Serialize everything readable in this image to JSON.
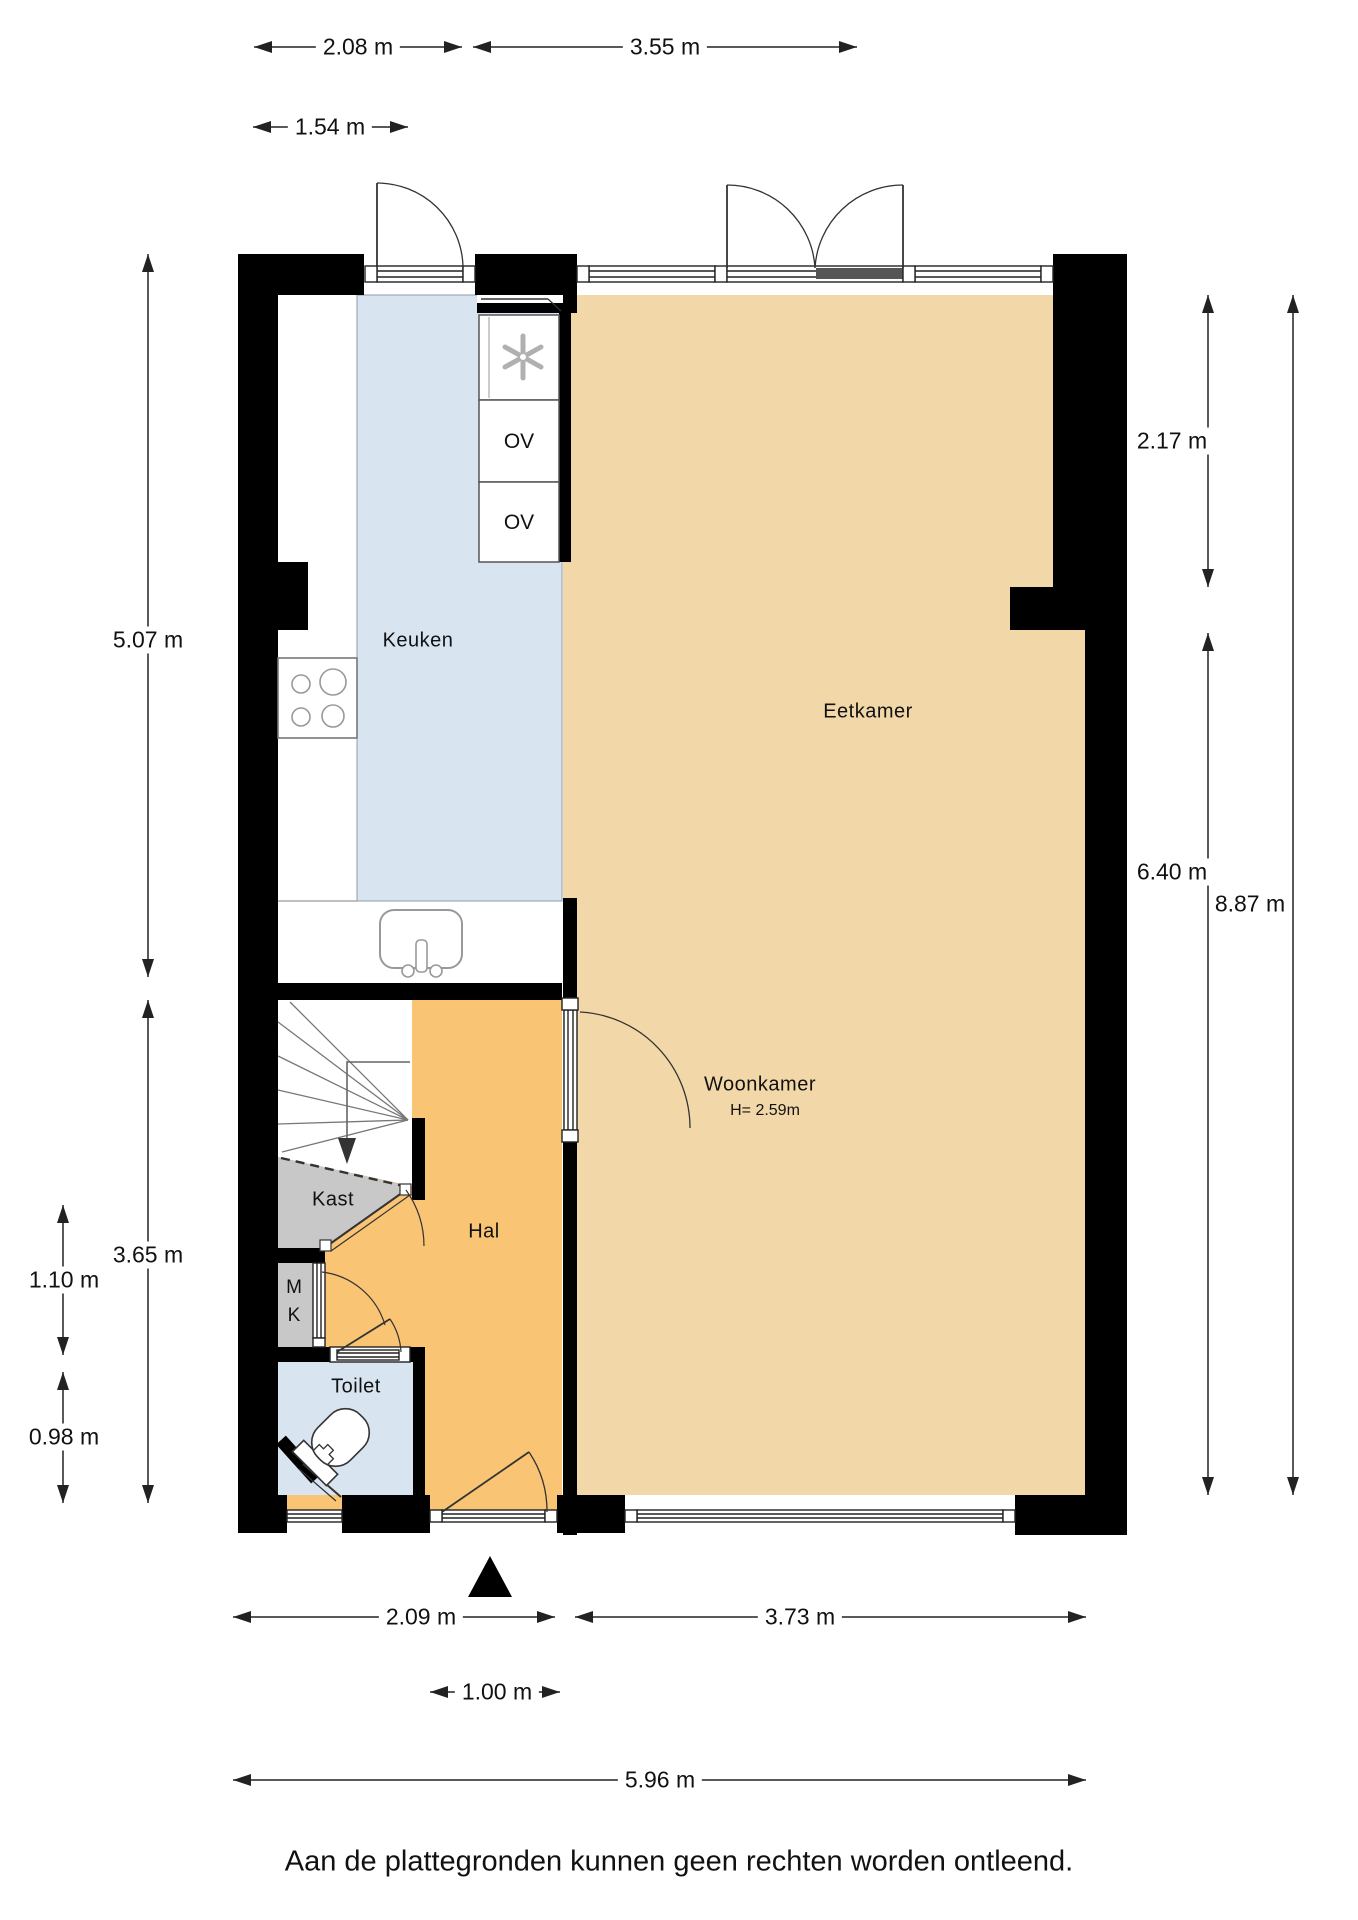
{
  "plan": {
    "rooms": {
      "keuken": "Keuken",
      "eetkamer": "Eetkamer",
      "woonkamer": "Woonkamer",
      "woonkamer_ceiling": "H= 2.59m",
      "hal": "Hal",
      "kast": "Kast",
      "meterkast_line1": "M",
      "meterkast_line2": "K",
      "toilet": "Toilet",
      "oven_top": "OV",
      "oven_bottom": "OV"
    },
    "dimensions": {
      "top_left_width": "2.08 m",
      "top_right_width": "3.55 m",
      "top_inner_width": "1.54 m",
      "left_upper_height": "5.07 m",
      "left_lower_height": "3.65 m",
      "left_closet_height": "1.10 m",
      "left_toilet_height": "0.98 m",
      "right_bay_height": "2.17 m",
      "right_lower_height": "6.40 m",
      "right_total_height": "8.87 m",
      "bottom_left_width": "2.09 m",
      "bottom_right_width": "3.73 m",
      "bottom_door_width": "1.00 m",
      "bottom_total_width": "5.96 m"
    },
    "footer_disclaimer": "Aan de plattegronden kunnen geen rechten worden ontleend.",
    "colors": {
      "kitchen_floor": "#d9e4f1",
      "living_floor": "#f2d8a9",
      "hall_floor": "#f9c474",
      "closet_floor": "#c8c8c8",
      "wall": "#000000",
      "dark_sill": "#555555"
    }
  }
}
